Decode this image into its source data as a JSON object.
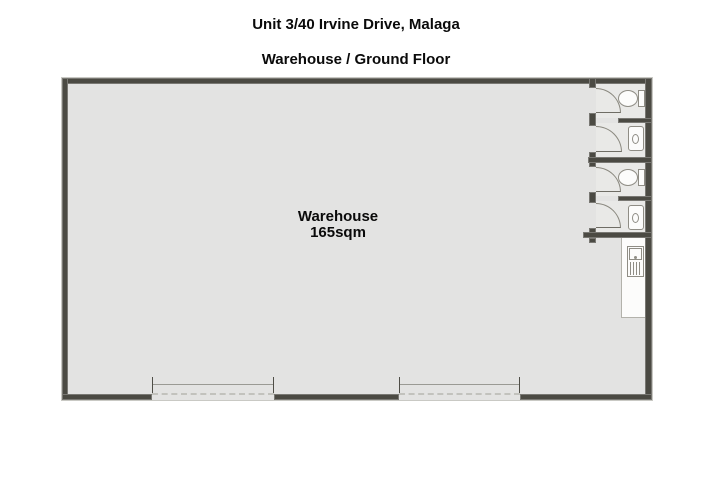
{
  "header": {
    "title": "Unit 3/40 Irvine Drive, Malaga",
    "subtitle": "Warehouse / Ground Floor"
  },
  "plan": {
    "room_label": "Warehouse",
    "room_area": "165sqm"
  },
  "icons": {
    "toilet-icon": "oval bowl with cistern against wall (css shapes)",
    "basin-icon": "rounded rectangle wall basin with oval bowl (css shapes)",
    "sink-icon": "square trough with tap dot and drainer lines (css shapes)",
    "door-swing-icon": "quarter-circle swing arc (css border-radius)",
    "roller-door-icon": "jambs, lintel line and dashed track (css borders)"
  },
  "colors": {
    "wall": "#4b4a43",
    "floor": "#e3e3e2",
    "bathfloor": "#e9e9e7",
    "fixfill": "#fcfcfb",
    "fixline": "#8f8d85",
    "text": "#0a0a0a",
    "bg": "#ffffff"
  }
}
